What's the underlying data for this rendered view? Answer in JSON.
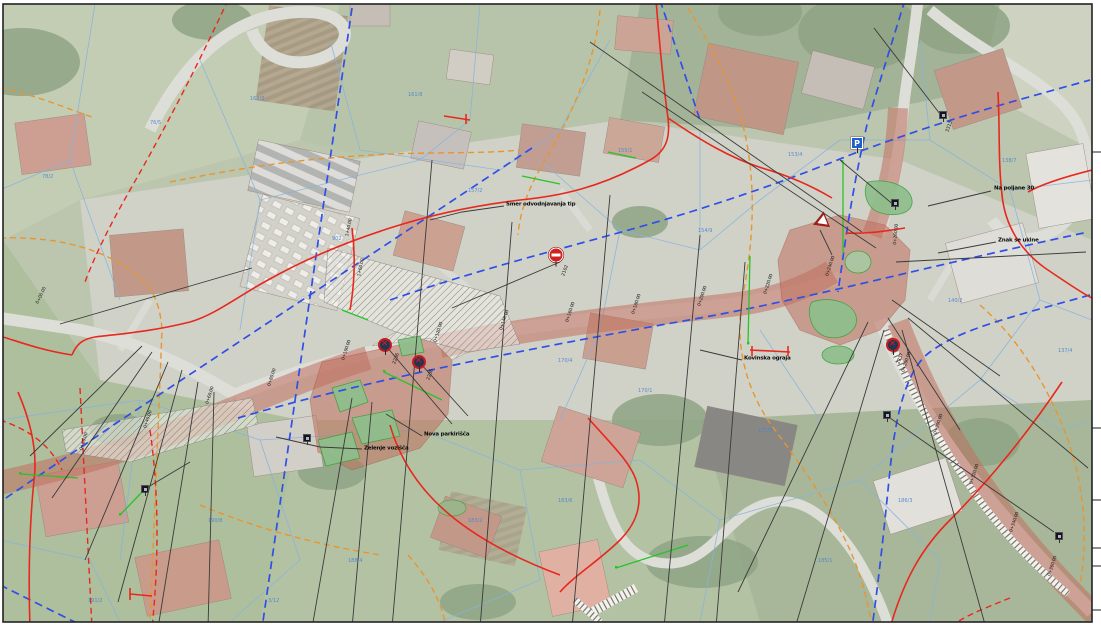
{
  "colors": {
    "corridor_fill": "#c0705f",
    "cadastral_red": "#e8281e",
    "utility_blue": "#2f4fe8",
    "utility_orange": "#e8952e",
    "parcel_line_blue": "#85b3e0",
    "island_green": "#8fbf8d",
    "marking_green": "#27c427",
    "leader_black": "#3a3a3a",
    "sign_red": "#d21f1f",
    "sign_blue": "#1f5fc9"
  },
  "annotations": {
    "labels": [
      {
        "text": "Smer odvodnjavanja tip",
        "x": 506,
        "y": 205
      },
      {
        "text": "Na poljane 30",
        "x": 994,
        "y": 189
      },
      {
        "text": "Znak se ukine",
        "x": 998,
        "y": 241
      },
      {
        "text": "Zelenje vozišča",
        "x": 364,
        "y": 449
      },
      {
        "text": "Nova parkirišča",
        "x": 424,
        "y": 435
      },
      {
        "text": "Kovinska ograja",
        "x": 744,
        "y": 359
      }
    ],
    "sign_codes": [
      {
        "text": "2102",
        "x": 566,
        "y": 272,
        "rot": -70
      },
      {
        "text": "2236",
        "x": 397,
        "y": 360,
        "rot": -70
      },
      {
        "text": "2236",
        "x": 431,
        "y": 376,
        "rot": -70
      },
      {
        "text": "2237",
        "x": 901,
        "y": 360,
        "rot": -70
      },
      {
        "text": "3313",
        "x": 950,
        "y": 128,
        "rot": -70
      }
    ]
  },
  "signs": [
    {
      "type": "no-entry",
      "x": 556,
      "y": 255
    },
    {
      "type": "no-stopping",
      "x": 385,
      "y": 345
    },
    {
      "type": "no-stopping",
      "x": 419,
      "y": 362
    },
    {
      "type": "no-stopping",
      "x": 893,
      "y": 345
    },
    {
      "type": "yield",
      "x": 820,
      "y": 222
    },
    {
      "type": "info-blue",
      "x": 857,
      "y": 143,
      "glyph": "P"
    },
    {
      "type": "marker-black",
      "x": 943,
      "y": 115
    },
    {
      "type": "marker-black",
      "x": 895,
      "y": 203
    },
    {
      "type": "marker-black",
      "x": 887,
      "y": 415
    },
    {
      "type": "marker-black",
      "x": 1059,
      "y": 536
    },
    {
      "type": "marker-black",
      "x": 145,
      "y": 489
    },
    {
      "type": "marker-black",
      "x": 307,
      "y": 438
    }
  ],
  "station_labels": [
    {
      "text": "0+00.00",
      "x": 40,
      "y": 300,
      "rot": -65
    },
    {
      "text": "0+20.00",
      "x": 84,
      "y": 446,
      "rot": -72
    },
    {
      "text": "0+40.00",
      "x": 148,
      "y": 424,
      "rot": -72
    },
    {
      "text": "0+60.00",
      "x": 210,
      "y": 400,
      "rot": -72
    },
    {
      "text": "0+80.00",
      "x": 272,
      "y": 382,
      "rot": -72
    },
    {
      "text": "0+100.00",
      "x": 346,
      "y": 356,
      "rot": -72
    },
    {
      "text": "0+120.00",
      "x": 438,
      "y": 338,
      "rot": -72
    },
    {
      "text": "0+140.00",
      "x": 504,
      "y": 326,
      "rot": -72
    },
    {
      "text": "0+160.00",
      "x": 570,
      "y": 318,
      "rot": -72
    },
    {
      "text": "0+180.00",
      "x": 636,
      "y": 310,
      "rot": -72
    },
    {
      "text": "0+200.00",
      "x": 702,
      "y": 302,
      "rot": -72
    },
    {
      "text": "0+220.00",
      "x": 768,
      "y": 290,
      "rot": -72
    },
    {
      "text": "0+240.00",
      "x": 830,
      "y": 272,
      "rot": -72
    },
    {
      "text": "0+260.00",
      "x": 898,
      "y": 240,
      "rot": -85
    },
    {
      "text": "0+280.00",
      "x": 906,
      "y": 368,
      "rot": -72
    },
    {
      "text": "0+300.00",
      "x": 938,
      "y": 430,
      "rot": -72
    },
    {
      "text": "0+320.00",
      "x": 974,
      "y": 480,
      "rot": -72
    },
    {
      "text": "0+340.00",
      "x": 1014,
      "y": 528,
      "rot": -72
    },
    {
      "text": "0+360.00",
      "x": 1052,
      "y": 572,
      "rot": -72
    },
    {
      "text": "1+40.00",
      "x": 350,
      "y": 232,
      "rot": -78
    },
    {
      "text": "1+60.00",
      "x": 362,
      "y": 272,
      "rot": -78
    }
  ],
  "parcel_numbers": [
    {
      "text": "78/2",
      "x": 42,
      "y": 174
    },
    {
      "text": "76/5",
      "x": 150,
      "y": 120
    },
    {
      "text": "162/3",
      "x": 250,
      "y": 96
    },
    {
      "text": "161/8",
      "x": 408,
      "y": 92
    },
    {
      "text": "902",
      "x": 332,
      "y": 236
    },
    {
      "text": "157/2",
      "x": 468,
      "y": 188
    },
    {
      "text": "155/1",
      "x": 618,
      "y": 148
    },
    {
      "text": "154/9",
      "x": 698,
      "y": 228
    },
    {
      "text": "153/4",
      "x": 788,
      "y": 152
    },
    {
      "text": "140/2",
      "x": 948,
      "y": 298
    },
    {
      "text": "138/7",
      "x": 1002,
      "y": 158
    },
    {
      "text": "137/4",
      "x": 1058,
      "y": 348
    },
    {
      "text": "170/4",
      "x": 558,
      "y": 358
    },
    {
      "text": "170/1",
      "x": 638,
      "y": 388
    },
    {
      "text": "171/3",
      "x": 758,
      "y": 428
    },
    {
      "text": "183/2",
      "x": 468,
      "y": 518
    },
    {
      "text": "183/6",
      "x": 558,
      "y": 498
    },
    {
      "text": "185/1",
      "x": 818,
      "y": 558
    },
    {
      "text": "186/3",
      "x": 898,
      "y": 498
    },
    {
      "text": "188/4",
      "x": 348,
      "y": 558
    },
    {
      "text": "190/8",
      "x": 208,
      "y": 518
    },
    {
      "text": "191/2",
      "x": 88,
      "y": 598
    },
    {
      "text": "3/12",
      "x": 268,
      "y": 598
    }
  ]
}
